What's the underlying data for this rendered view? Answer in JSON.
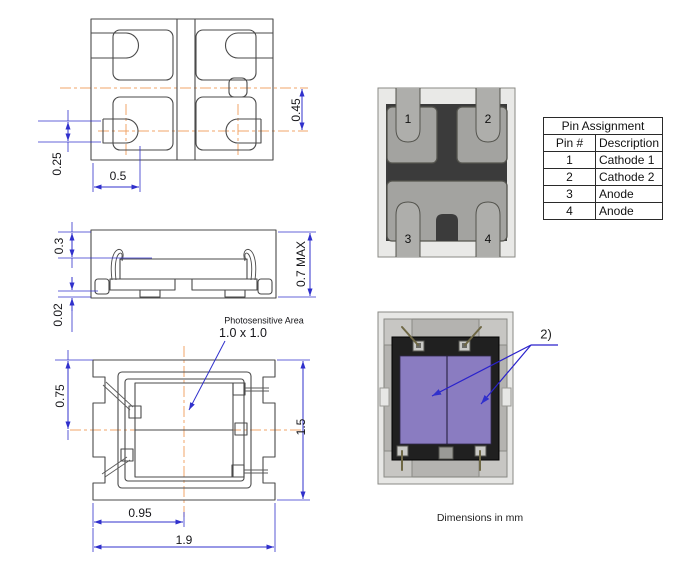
{
  "drawings": {
    "top_view": {
      "dim_045": "0.45",
      "dim_025": "0.25",
      "dim_05": "0.5"
    },
    "side_view": {
      "dim_03": "0.3",
      "dim_002": "0.02",
      "dim_07max": "0.7 MAX"
    },
    "bottom_view": {
      "dim_075": "0.75",
      "dim_15": "1.5",
      "dim_095": "0.95",
      "dim_19": "1.9",
      "photosensitive_label": "Photosensitive Area",
      "photosensitive_size": "1.0 x 1.0"
    }
  },
  "renders": {
    "pad_view": {
      "pins": [
        "1",
        "2",
        "3",
        "4"
      ]
    },
    "top_view": {
      "note_label": "2)"
    }
  },
  "table": {
    "title": "Pin Assignment",
    "columns": [
      "Pin #",
      "Description"
    ],
    "rows": [
      [
        "1",
        "Cathode 1"
      ],
      [
        "2",
        "Cathode 2"
      ],
      [
        "3",
        "Anode"
      ],
      [
        "4",
        "Anode"
      ]
    ]
  },
  "footer": {
    "units_note": "Dimensions in mm"
  },
  "colors": {
    "dimension_blue": "#3030cc",
    "centerline_orange": "#f0a468",
    "outline_gray": "#4a4a4a",
    "photosensitive_purple": "#8a7cc1",
    "substrate_gray": "#e8e8e6",
    "body_dark": "#3b3b3b",
    "pad_gray": "#a3a3a0"
  }
}
